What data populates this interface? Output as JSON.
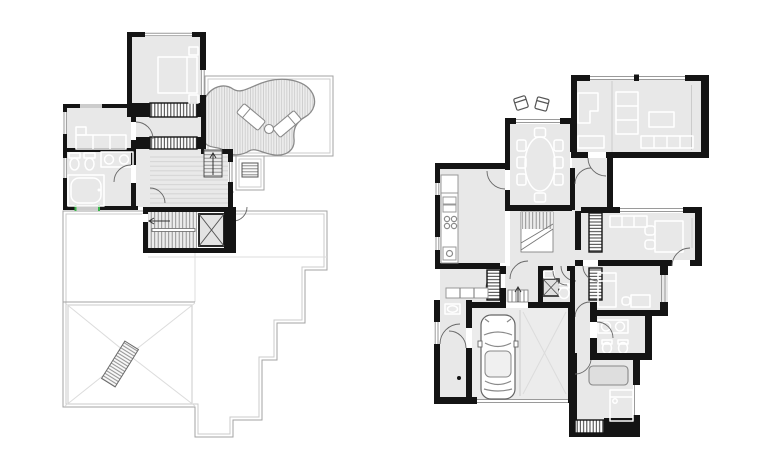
{
  "page": {
    "background": "#ffffff",
    "description": "Two architectural floor plans of a house drawn side by side on a white sheet: upper floor with roof terrace (left) and ground floor with garage (right). No text labels are printed on the sheet."
  },
  "colors": {
    "paper": "#ffffff",
    "wall": "#141414",
    "floor": "#e8e8e8",
    "furniture": "#ffffff",
    "line-mid": "#8a8a8a",
    "line-light": "#c8c8c8",
    "accent-green": "#39b54a"
  },
  "plans": [
    {
      "id": "upper-floor",
      "label": "Upper floor plan: bedroom, dressing corridor with two wardrobe strips, bathroom with tub, WC and twin basins, sofa room, hall with wood floor, U-shaped stair with cross-hatched shaft, roof terrace with organic deck, two sun loungers and side table, entry canopy with rooflight, stepped flat-roof outline and hip roof with striped rooflight panel",
      "position": "left",
      "rooms": [
        "bedroom",
        "dressing-corridor",
        "sofa-room",
        "bathroom",
        "hall",
        "stair-room",
        "roof-terrace"
      ],
      "features": [
        "double-bed-with-nightstands",
        "wardrobe-strip-x2",
        "sofa",
        "bathtub",
        "wc-and-bidet",
        "twin-round-washbasins",
        "u-shaped-stair",
        "cross-hatched-shaft",
        "terrace-steps-with-up-arrow",
        "organic-deck",
        "sun-lounger-x2",
        "round-side-table",
        "entry-canopy-rooflight",
        "hip-roof",
        "striped-roof-panel",
        "round-column"
      ],
      "counts": {
        "sun_loungers": 2,
        "wardrobe_strips": 2,
        "washbasins": 2
      }
    },
    {
      "id": "ground-floor",
      "label": "Ground floor plan: living room with sofas, bookshelf and coffee table, dining room with oval table and eight chairs, two outdoor chairs on the entry terrace, kitchen with counter, sink, cooktop and oven, L-shaped stair, corridor with guest WC and shaft, office with desk and two chairs, two bedrooms, bathroom with double basin, WC and bidet, utility entry and double garage with one parked car",
      "position": "right",
      "rooms": [
        "living-room",
        "dining-room",
        "entrance-hall",
        "kitchen",
        "pantry",
        "stair-hall",
        "corridor",
        "guest-wc",
        "office",
        "bedroom-middle",
        "bathroom",
        "bedroom-corridor",
        "bedroom-bottom",
        "utility-entry",
        "garage"
      ],
      "features": [
        "l-sofa",
        "bookshelf",
        "coffee-table",
        "modular-sofa",
        "dining-table-oval",
        "dining-chair-x8",
        "outdoor-chair-x2",
        "kitchen-counter",
        "double-sink",
        "cooktop-4-burners",
        "oven",
        "l-shaped-stair",
        "cross-hatched-shaft",
        "guest-wc-toilet",
        "guest-wc-basin",
        "office-shelf",
        "desk-with-two-chairs",
        "single-bed",
        "desk",
        "wardrobe-strip-x4",
        "double-washbasin",
        "wc-and-bidet",
        "bed",
        "sofa-bed",
        "car-top-view",
        "garage-door",
        "entry-steps-with-up-arrow",
        "round-column"
      ],
      "counts": {
        "dining_chairs": 8,
        "garage_bays": 2,
        "outdoor_chairs": 2,
        "cooktop_burners": 4
      }
    }
  ]
}
